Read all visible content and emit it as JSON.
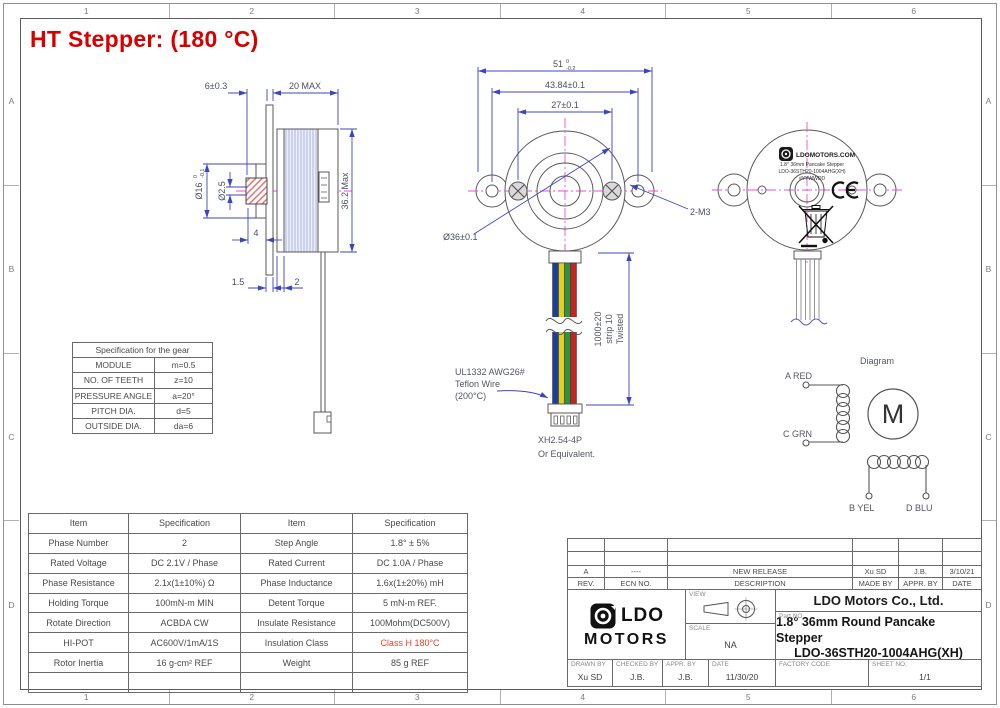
{
  "page": {
    "title": "HT Stepper: (180 °C)",
    "zone_columns": [
      "1",
      "2",
      "3",
      "4",
      "5",
      "6"
    ],
    "zone_rows": [
      "A",
      "B",
      "C",
      "D"
    ]
  },
  "colors": {
    "title_red": "#d60000",
    "dimension_blue": "#3d44c3",
    "centerline_magenta": "#ea4fd8",
    "insulation_class_red": "#e04327",
    "wire_blue": "#1d3f9c",
    "wire_yellow": "#e3cf1d",
    "wire_green": "#2e9240",
    "wire_red": "#c42320"
  },
  "side_view": {
    "dim_gear_length": "6±0.3",
    "dim_body_length": "20 MAX",
    "dim_gear_od": "Ø16",
    "dim_gear_od_tol_upper": "0",
    "dim_gear_od_tol_lower": "-0.1",
    "dim_bore": "Ø2.5",
    "dim_body_od": "36.2 Max",
    "dim_boss": "4",
    "dim_flange_thk": "1.5",
    "dim_plate_thk": "2"
  },
  "front_view": {
    "dim_tab_width": "51",
    "dim_tab_width_tol_upper": "0",
    "dim_tab_width_tol_lower": "-0.2",
    "dim_hole_span": "43.84±0.1",
    "dim_screw_span": "27±0.1",
    "dim_body_dia": "Ø36±0.1",
    "label_mounting_holes": "2-M3",
    "wire_note_line1": "UL1332 AWG26#",
    "wire_note_line2": "Teflon Wire",
    "wire_note_line3": "(200°C)",
    "length_note_line1": "1000±20",
    "length_note_line2": "strip 10",
    "length_note_line3": "Twisted",
    "connector_line1": "XH2.54-4P",
    "connector_line2": "Or Equivalent."
  },
  "rear_view": {
    "label_brand": "LDOMOTORS.COM",
    "label_line1": "1.8° 36mm Pancake Stepper",
    "label_line2": "LDO-36STH20-1004AHG(XH)",
    "label_line3": "#YYWWDD"
  },
  "gear_table": {
    "title": "Specification for the gear",
    "rows": [
      {
        "item": "MODULE",
        "value": "m=0.5"
      },
      {
        "item": "NO. OF TEETH",
        "value": "z=10"
      },
      {
        "item": "PRESSURE ANGLE",
        "value": "a=20°"
      },
      {
        "item": "PITCH DIA.",
        "value": "d=5"
      },
      {
        "item": "OUTSIDE DIA.",
        "value": "da=6"
      }
    ]
  },
  "spec_table": {
    "headers": [
      "Item",
      "Specification",
      "Item",
      "Specification"
    ],
    "rows": [
      [
        "Phase Number",
        "2",
        "Step Angle",
        "1.8° ± 5%"
      ],
      [
        "Rated Voltage",
        "DC 2.1V / Phase",
        "Rated Current",
        "DC 1.0A / Phase"
      ],
      [
        "Phase Resistance",
        "2.1x(1±10%) Ω",
        "Phase Inductance",
        "1.6x(1±20%) mH"
      ],
      [
        "Holding Torque",
        "100mN-m MIN",
        "Detent Torque",
        "5 mN-m REF."
      ],
      [
        "Rotate Direction",
        "ACBDA CW",
        "Insulate Resistance",
        "100Mohm(DC500V)"
      ],
      [
        "HI-POT",
        "AC600V/1mA/1S",
        "Insulation Class",
        "Class H 180°C"
      ],
      [
        "Rotor Inertia",
        "16 g-cm² REF",
        "Weight",
        "85 g REF"
      ]
    ]
  },
  "wiring_diagram": {
    "title": "Diagram",
    "motor_symbol": "M",
    "terminal_a": "A RED",
    "terminal_c": "C GRN",
    "terminal_b": "B YEL",
    "terminal_d": "D BLU"
  },
  "title_block": {
    "revision": {
      "rev": "A",
      "ecn": "----",
      "description": "NEW RELEASE",
      "made_by": "Xu SD",
      "appr_by": "J.B.",
      "date": "3/10/21"
    },
    "revision_headers": {
      "rev": "REV.",
      "ecn": "ECN NO.",
      "description": "DESCRIPTION",
      "made_by": "MADE BY",
      "appr_by": "APPR. BY",
      "date": "DATE"
    },
    "logo_line1": "LDO",
    "logo_line2": "MOTORS",
    "view_label": "VIEW",
    "scale_label": "SCALE",
    "scale_value": "NA",
    "company": "LDO Motors Co., Ltd.",
    "part_no_label": "Part NO.",
    "part_title": "1.8° 36mm Round Pancake Stepper",
    "part_number": "LDO-36STH20-1004AHG(XH)",
    "drawn_by_label": "DRAWN BY",
    "drawn_by": "Xu SD",
    "checked_by_label": "CHECKED BY",
    "checked_by": "J.B.",
    "appr_by_label": "APPR. BY",
    "appr_by": "J.B.",
    "date_label": "DATE",
    "date": "11/30/20",
    "factory_code_label": "FACTORY CODE",
    "factory_code": "",
    "sheet_no_label": "SHEET NO.",
    "sheet_no": "1/1"
  }
}
